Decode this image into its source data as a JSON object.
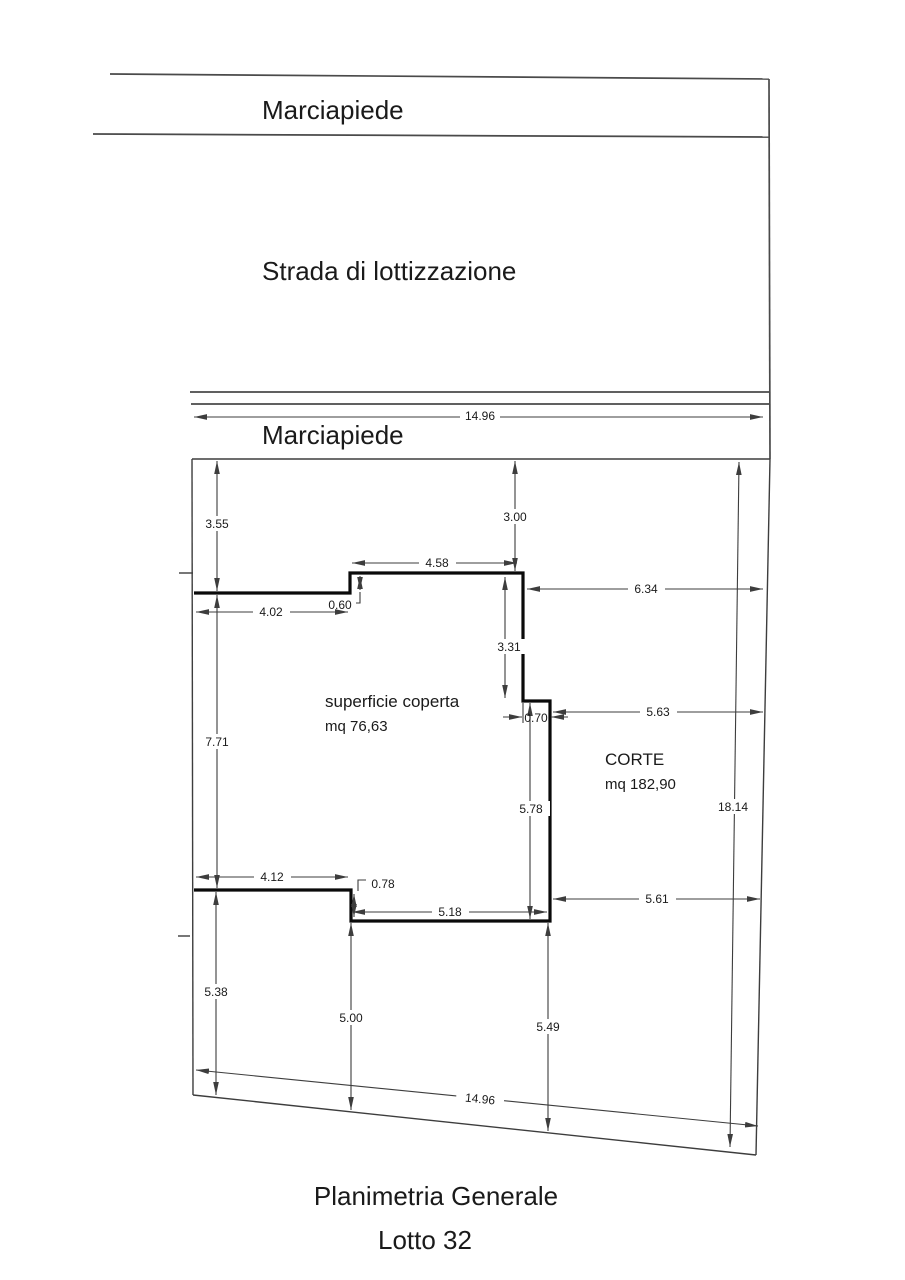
{
  "labels": {
    "sidewalk_top": "Marciapiede",
    "road": "Strada di lottizzazione",
    "sidewalk_lot": "Marciapiede",
    "covered_surface_title": "superficie coperta",
    "covered_surface_area": "mq 76,63",
    "court_title": "CORTE",
    "court_area": "mq 182,90",
    "caption_title": "Planimetria Generale",
    "caption_subtitle": "Lotto 32"
  },
  "dims": {
    "front_width": "14.96",
    "side_left_upper": "3.55",
    "side_left_middle": "7.71",
    "side_left_lower": "5.38",
    "setback_front": "3.00",
    "top_edge_left": "4.02",
    "top_step": "0.60",
    "top_edge_upper": "4.58",
    "gap_right_upper": "6.34",
    "right_edge_upper": "3.31",
    "right_step": "0.70",
    "gap_right_middle": "5.63",
    "bottom_edge_left": "4.12",
    "bottom_step": "0.78",
    "bottom_edge": "5.18",
    "right_edge_lower": "5.78",
    "gap_right_lower": "5.61",
    "side_right": "18.14",
    "rear_gap_left": "5.00",
    "rear_gap_right": "5.49",
    "rear_width": "14.96"
  },
  "colors": {
    "thin_line": "#3d3d3d",
    "building_line": "#0a0a0a",
    "text": "#1a1a1a"
  }
}
